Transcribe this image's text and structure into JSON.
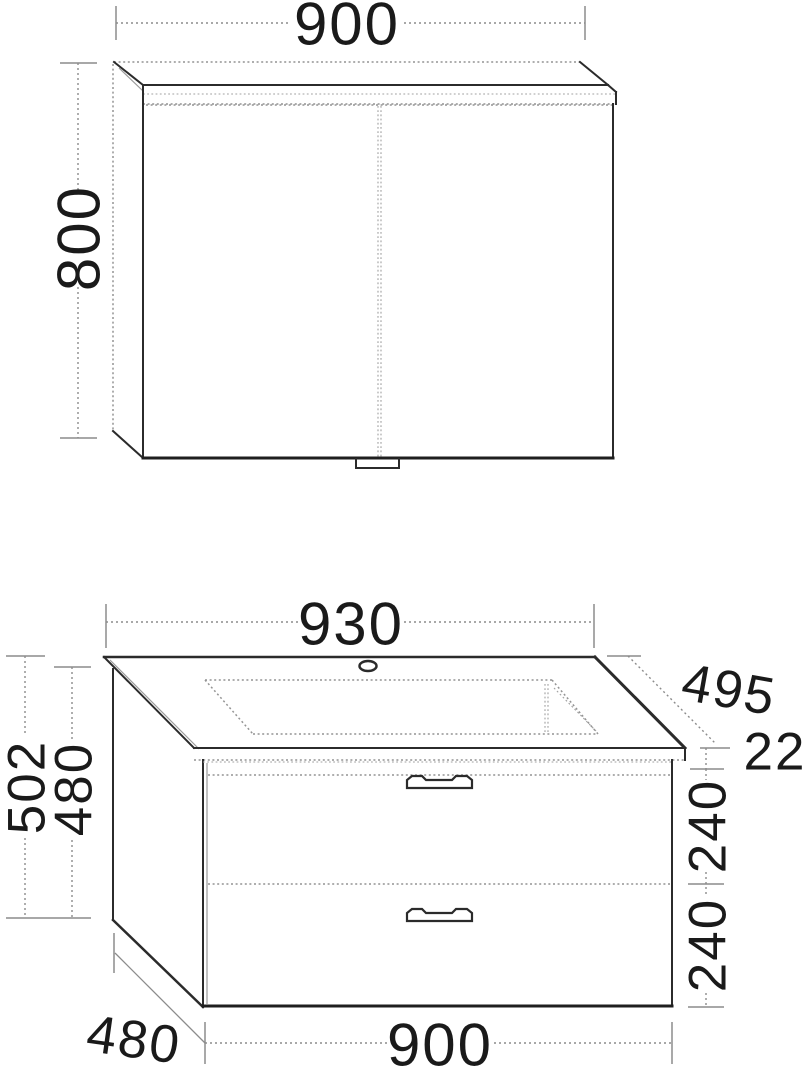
{
  "figure": {
    "kind": "furniture-dimension-drawing",
    "background_color": "#ffffff",
    "line_color": "#2b2b2b",
    "hidden_line_color": "#949494",
    "dim_text_color": "#1a1a1a",
    "mirror_cabinet": {
      "description": "two-door mirror cabinet with light canopy, front view",
      "width_label": "900",
      "height_label": "800"
    },
    "vanity": {
      "description": "washbasin with vanity unit, two drawers, perspective view",
      "basin_width_label": "930",
      "basin_depth_label": "495",
      "basin_thickness_label": "22",
      "total_height_label": "502",
      "carcass_height_label": "480",
      "drawer_top_label": "240",
      "drawer_bottom_label": "240",
      "carcass_width_label": "900",
      "carcass_depth_label": "480"
    }
  }
}
